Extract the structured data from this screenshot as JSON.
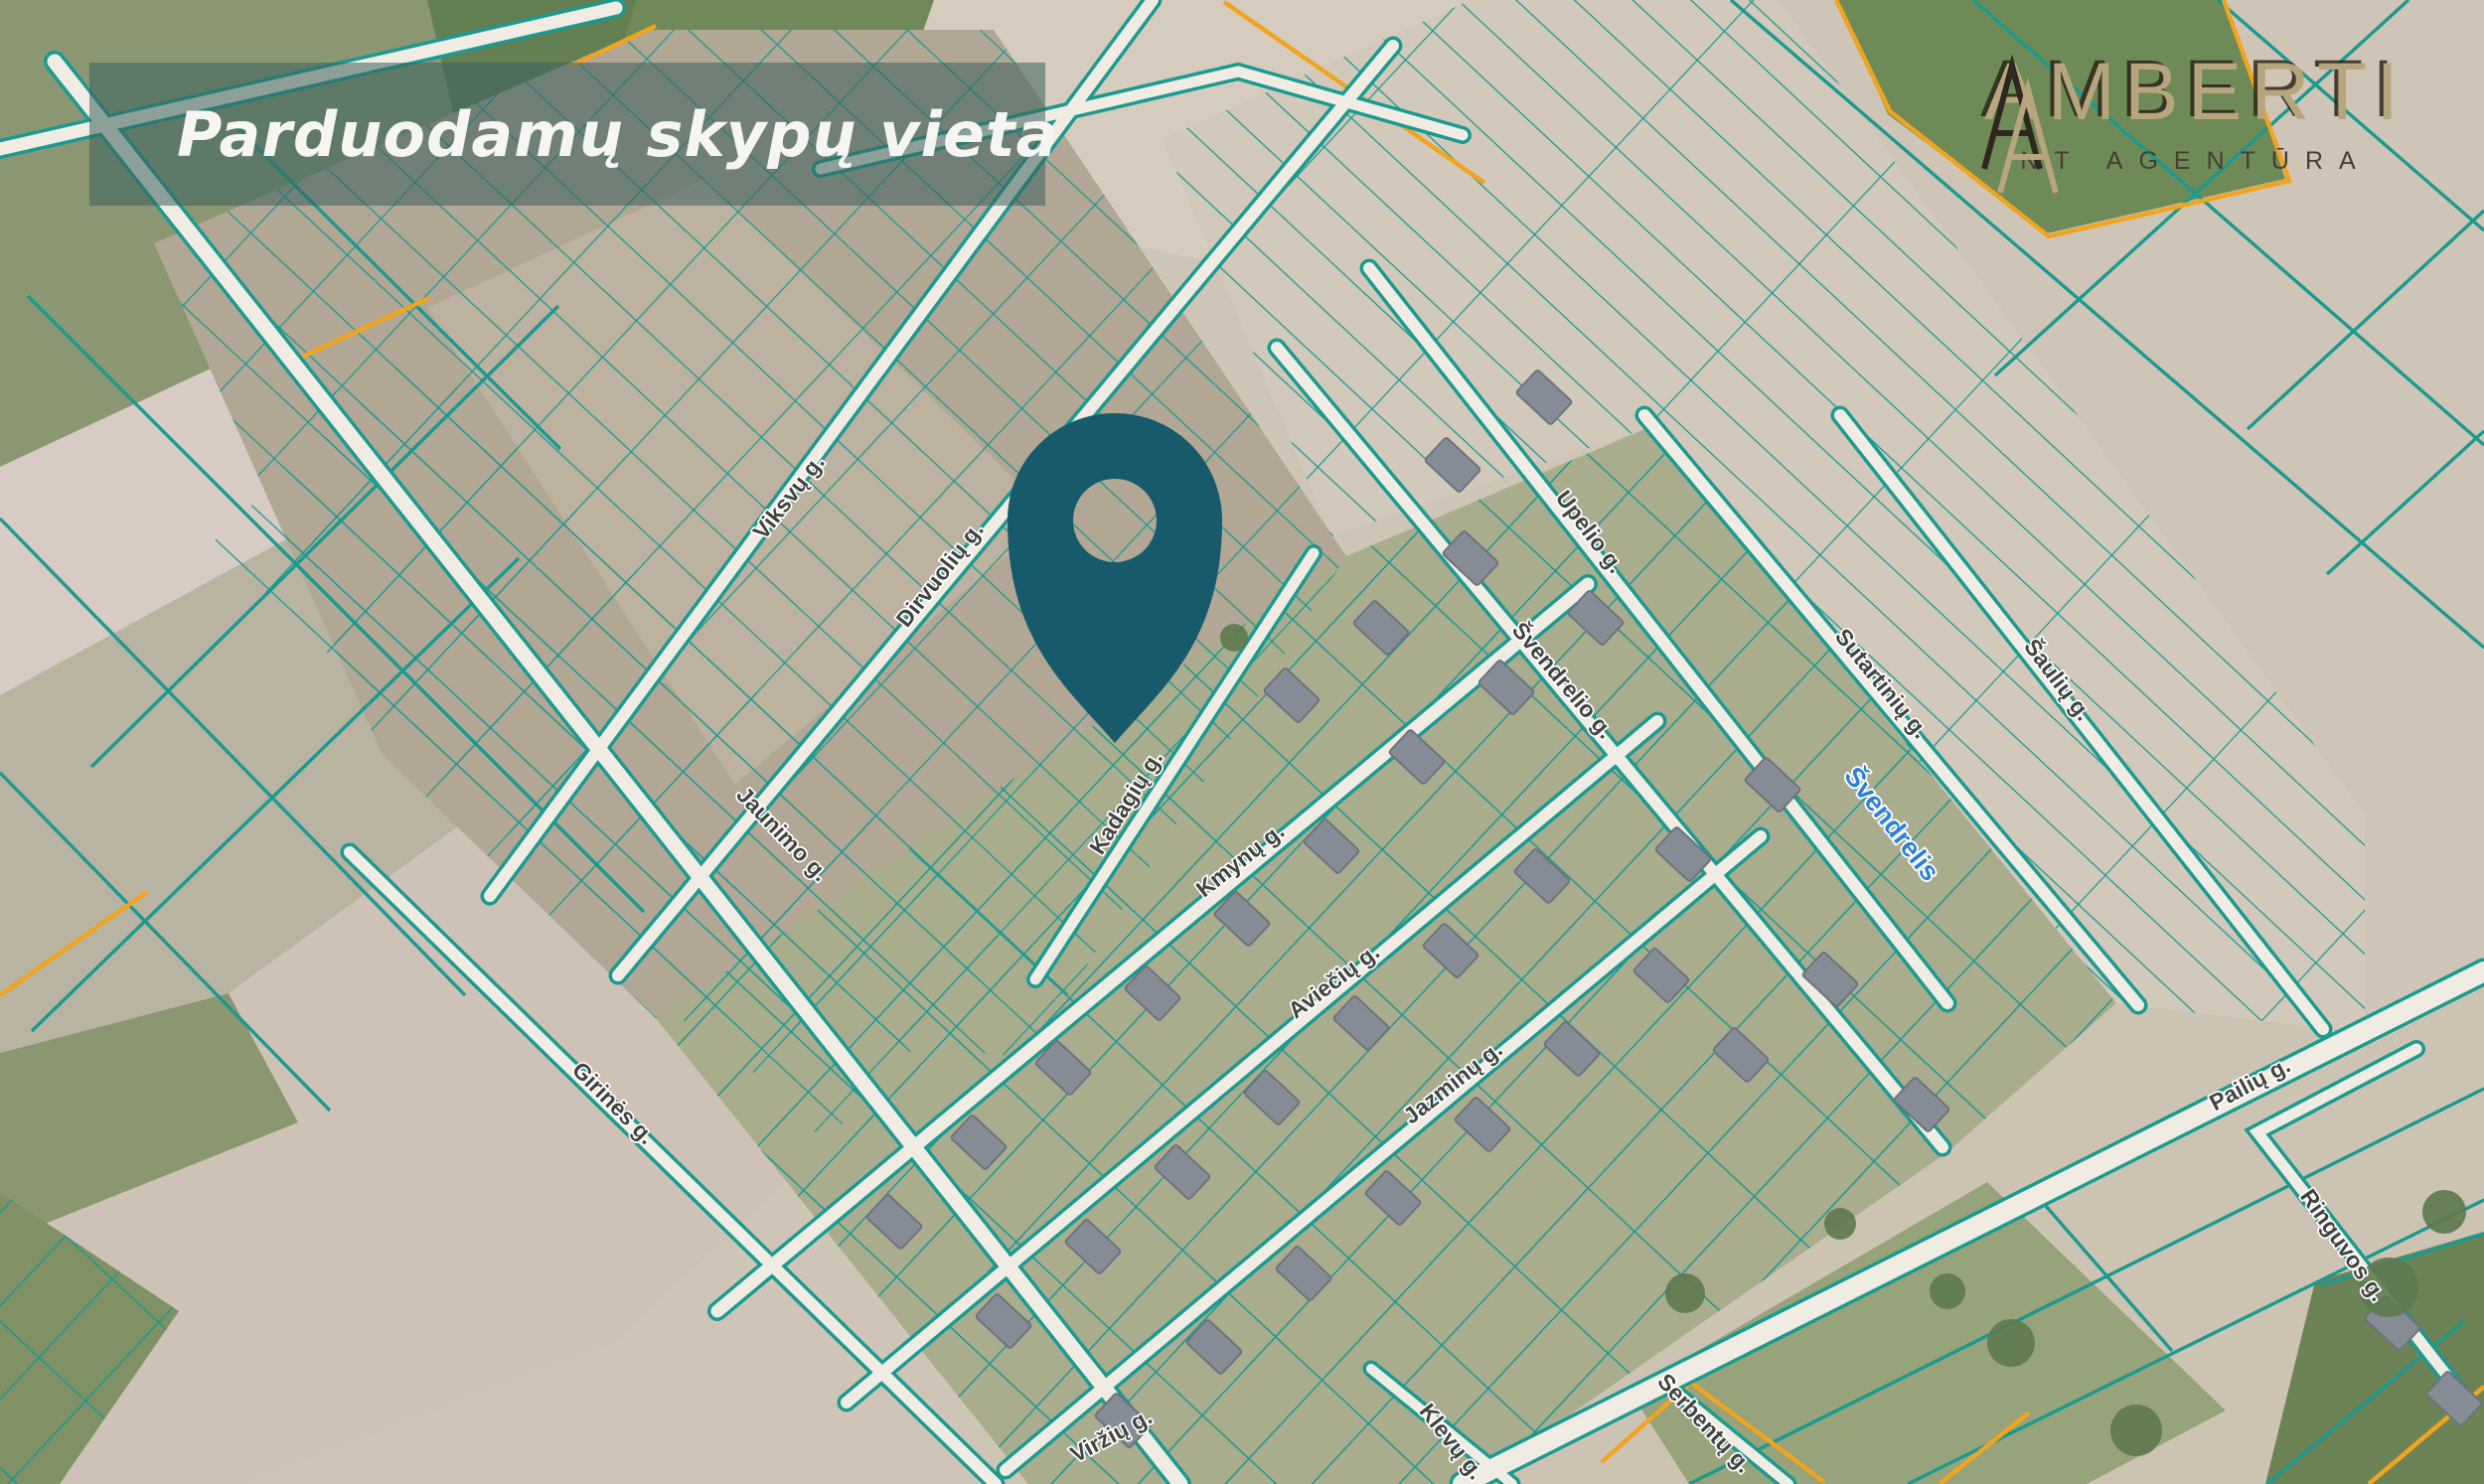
{
  "banner": {
    "title": "Parduodamų skypų vieta"
  },
  "logo": {
    "brand": "AMBERTI",
    "subtitle": "NT AGENTŪRA"
  },
  "map": {
    "street_labels": [
      {
        "text": "Viksvų g."
      },
      {
        "text": "Dirvuolių g."
      },
      {
        "text": "Jaunimo g."
      },
      {
        "text": "Upelio g."
      },
      {
        "text": "Švendrelio g."
      },
      {
        "text": "Kadagių g."
      },
      {
        "text": "Kmynų g."
      },
      {
        "text": "Aviečių g."
      },
      {
        "text": "Jazminų g."
      },
      {
        "text": "Sutartinių g."
      },
      {
        "text": "Šaulių g."
      },
      {
        "text": "Girinės g."
      },
      {
        "text": "Viržių g."
      },
      {
        "text": "Klevų g."
      },
      {
        "text": "Serbentų g."
      },
      {
        "text": "Pailių g."
      },
      {
        "text": "Ringuvos g."
      }
    ],
    "water_label": {
      "text": "Švendrelis"
    },
    "colors": {
      "parcel_line": "#1a9a90",
      "boundary_orange": "#f0a41f",
      "pin": "#175a6c",
      "brand_gold": "#b6a57d",
      "banner_overlay": "rgba(58,96,92,0.55)"
    }
  }
}
